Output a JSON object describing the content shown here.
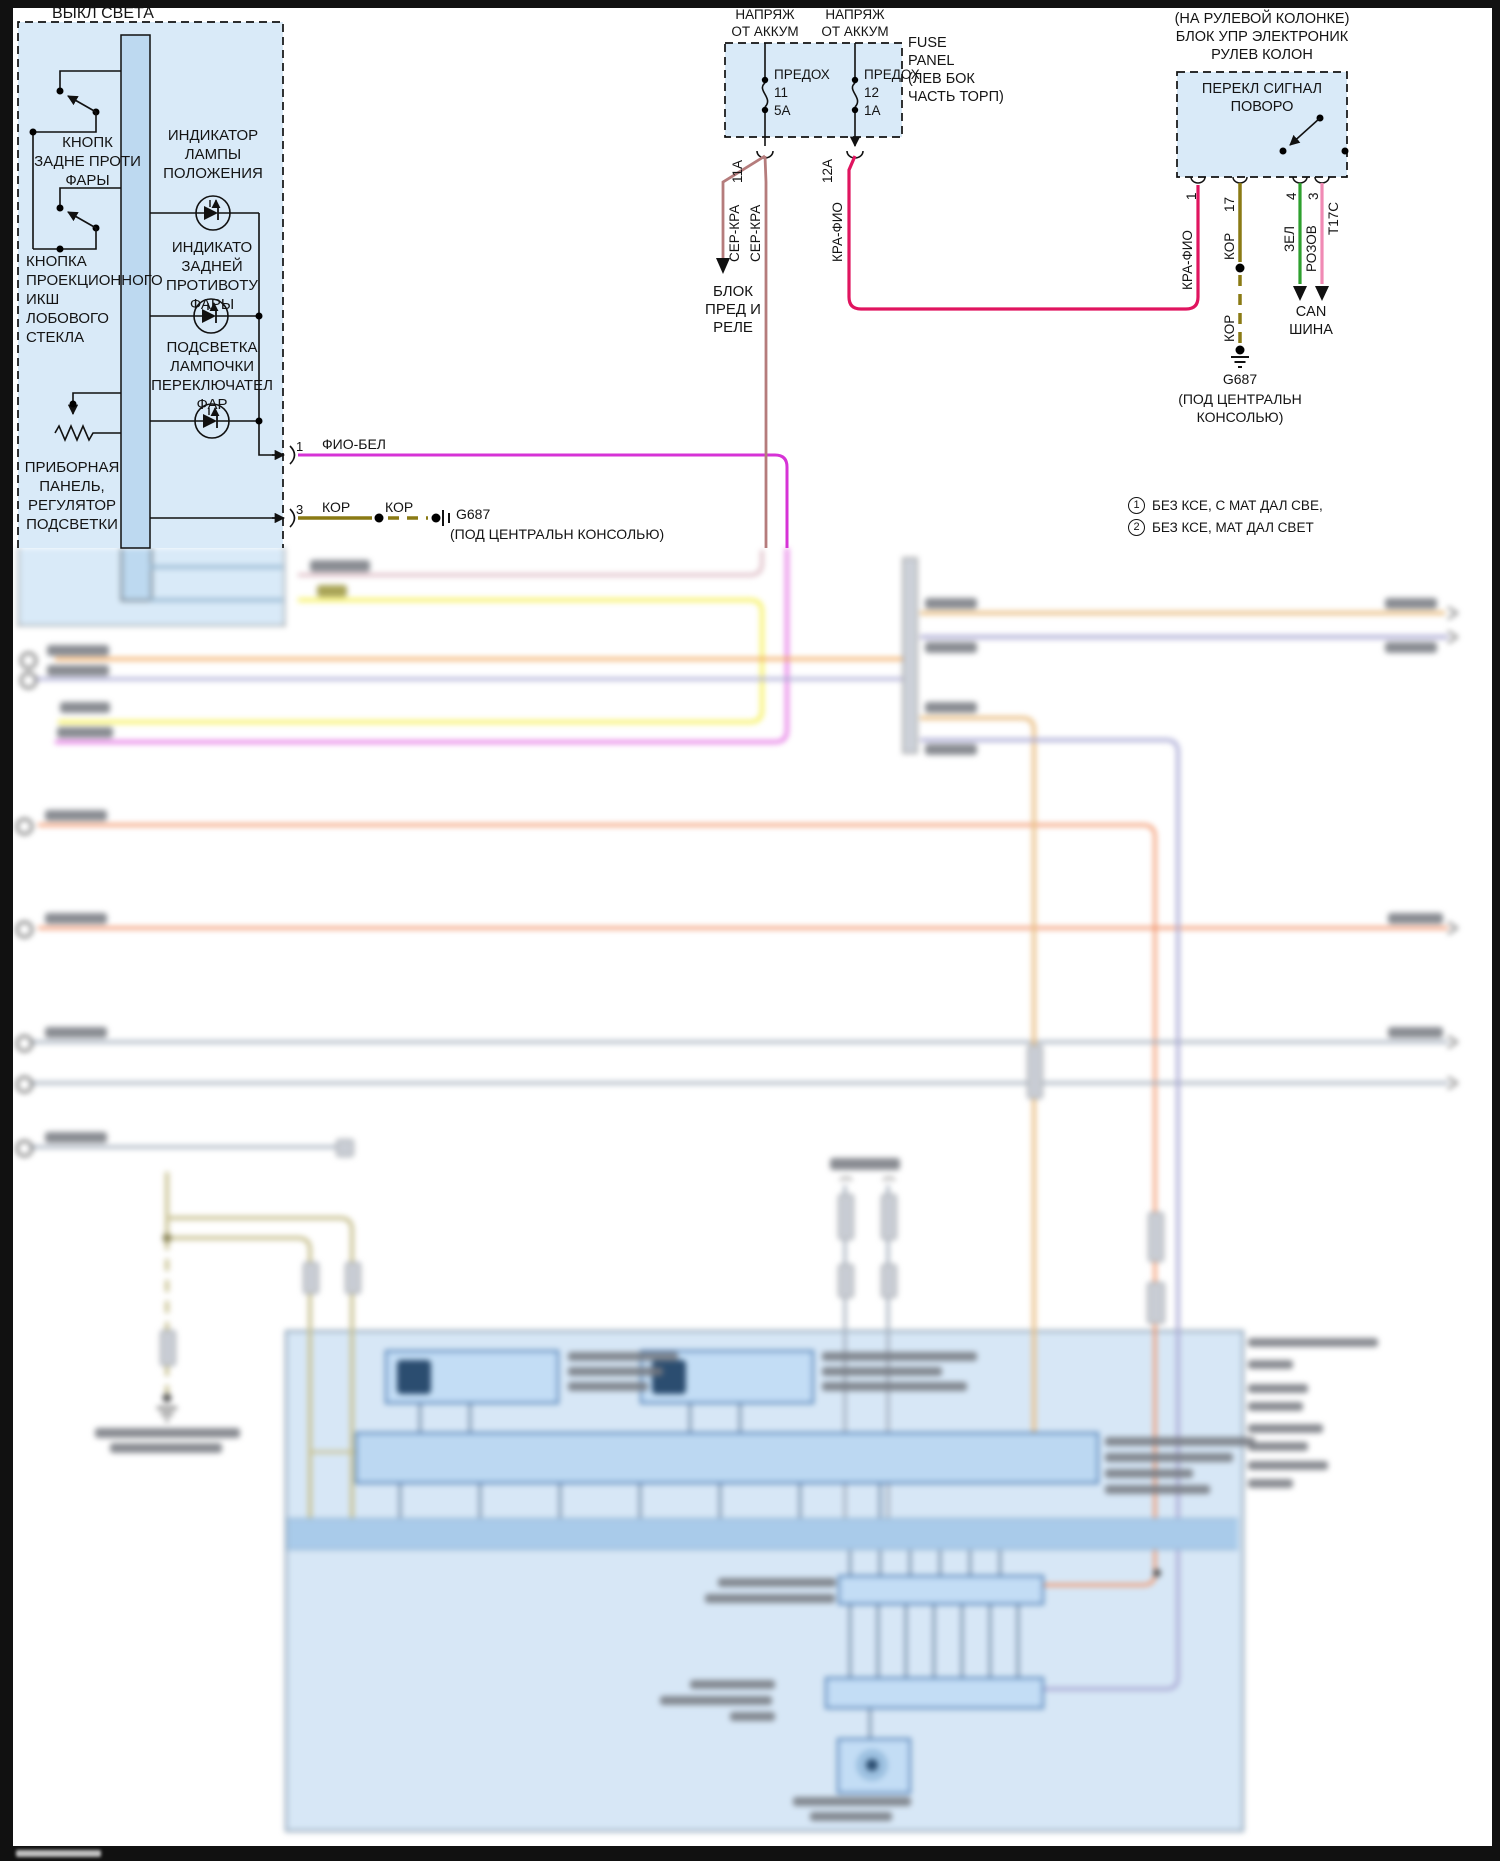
{
  "colors": {
    "box_fill": "#d9eaf8",
    "busbar_fill": "#bdd9f0",
    "wire_fio_bel": "#d633d6",
    "wire_kor": "#8a7a14",
    "wire_ser_kra": "#b57c7c",
    "wire_kra_fio": "#e0145f",
    "wire_zel": "#2ea02e",
    "wire_rozov": "#f08ab4",
    "wire_orange": "#f2a557",
    "wire_salmon": "#f2936b",
    "wire_yellow": "#f7f26a",
    "wire_lavender": "#a9a9d4",
    "wire_grey": "#a3aebc",
    "wire_olive_pale": "#c9c293",
    "wire_amber": "#eac087",
    "module_fill": "#d7e7f6"
  },
  "light_switch": {
    "title": "ВЫКЛ СВЕТА",
    "switch1_label": "КНОПК\nЗАДНЕ ПРОТИ\nФАРЫ",
    "indicator1": "ИНДИКАТОР\nЛАМПЫ\nПОЛОЖЕНИЯ",
    "switch2_label": "КНОПКА\nПРОЕКЦИОННОГО\nИКШ\nЛОБОВОГО\nСТЕКЛА",
    "indicator2": "ИНДИКАТО\nЗАДНЕЙ\nПРОТИВОТУ\nФАРЫ",
    "indicator3": "ПОДСВЕТКА\nЛАМПОЧКИ\nПЕРЕКЛЮЧАТЕЛ\nФАР",
    "dimmer_label": "ПРИБОРНАЯ\nПАНЕЛЬ,\nРЕГУЛЯТОР\nПОДСВЕТКИ",
    "pin1": {
      "num": "1",
      "wire": "ФИО-БЕЛ"
    },
    "pin3": {
      "num": "3",
      "wire": "КОР",
      "splice_wire": "КОР",
      "ground": "G687",
      "ground_note": "(ПОД ЦЕНТРАЛЬН КОНСОЛЬЮ)"
    }
  },
  "fuse_panel": {
    "feed": "НАПРЯЖ\nОТ АККУМ",
    "name": "FUSE\nPANEL\n(ЛЕВ БОК\nЧАСТЬ ТОРП)",
    "fuse1": "ПРЕДОХ\n11\n5А",
    "fuse2": "ПРЕДОХ\n12\n1А",
    "pin1": "11А",
    "pin2": "12А",
    "wire1": "СЕР-КРА",
    "wire2": "СЕР-КРА",
    "wire3": "КРА-ФИО",
    "dest": "БЛОК\nПРЕД И\nРЕЛЕ"
  },
  "turn_signal": {
    "header": "(НА РУЛЕВОЙ КОЛОНКЕ)\nБЛОК УПР ЭЛЕКТРОНИК\nРУЛЕВ КОЛОН",
    "label": "ПЕРЕКЛ СИГНАЛ\nПОВОРО",
    "connector": "Т17С",
    "pin1": "1",
    "pin17": "17",
    "pin4": "4",
    "pin3": "3",
    "wire1": "КРА-ФИО",
    "wire17a": "КОР",
    "wire17b": "КОР",
    "wire4": "ЗЕЛ",
    "wire3": "РОЗОВ",
    "ground": "G687",
    "ground_note": "(ПОД ЦЕНТРАЛЬН\nКОНСОЛЬЮ)",
    "can": "CAN\nШИНА"
  },
  "notes": [
    {
      "num": "1",
      "text": "БЕЗ КСЕ, С МАТ ДАЛ СВЕ,"
    },
    {
      "num": "2",
      "text": "БЕЗ КСЕ, МАТ ДАЛ СВЕТ"
    }
  ]
}
